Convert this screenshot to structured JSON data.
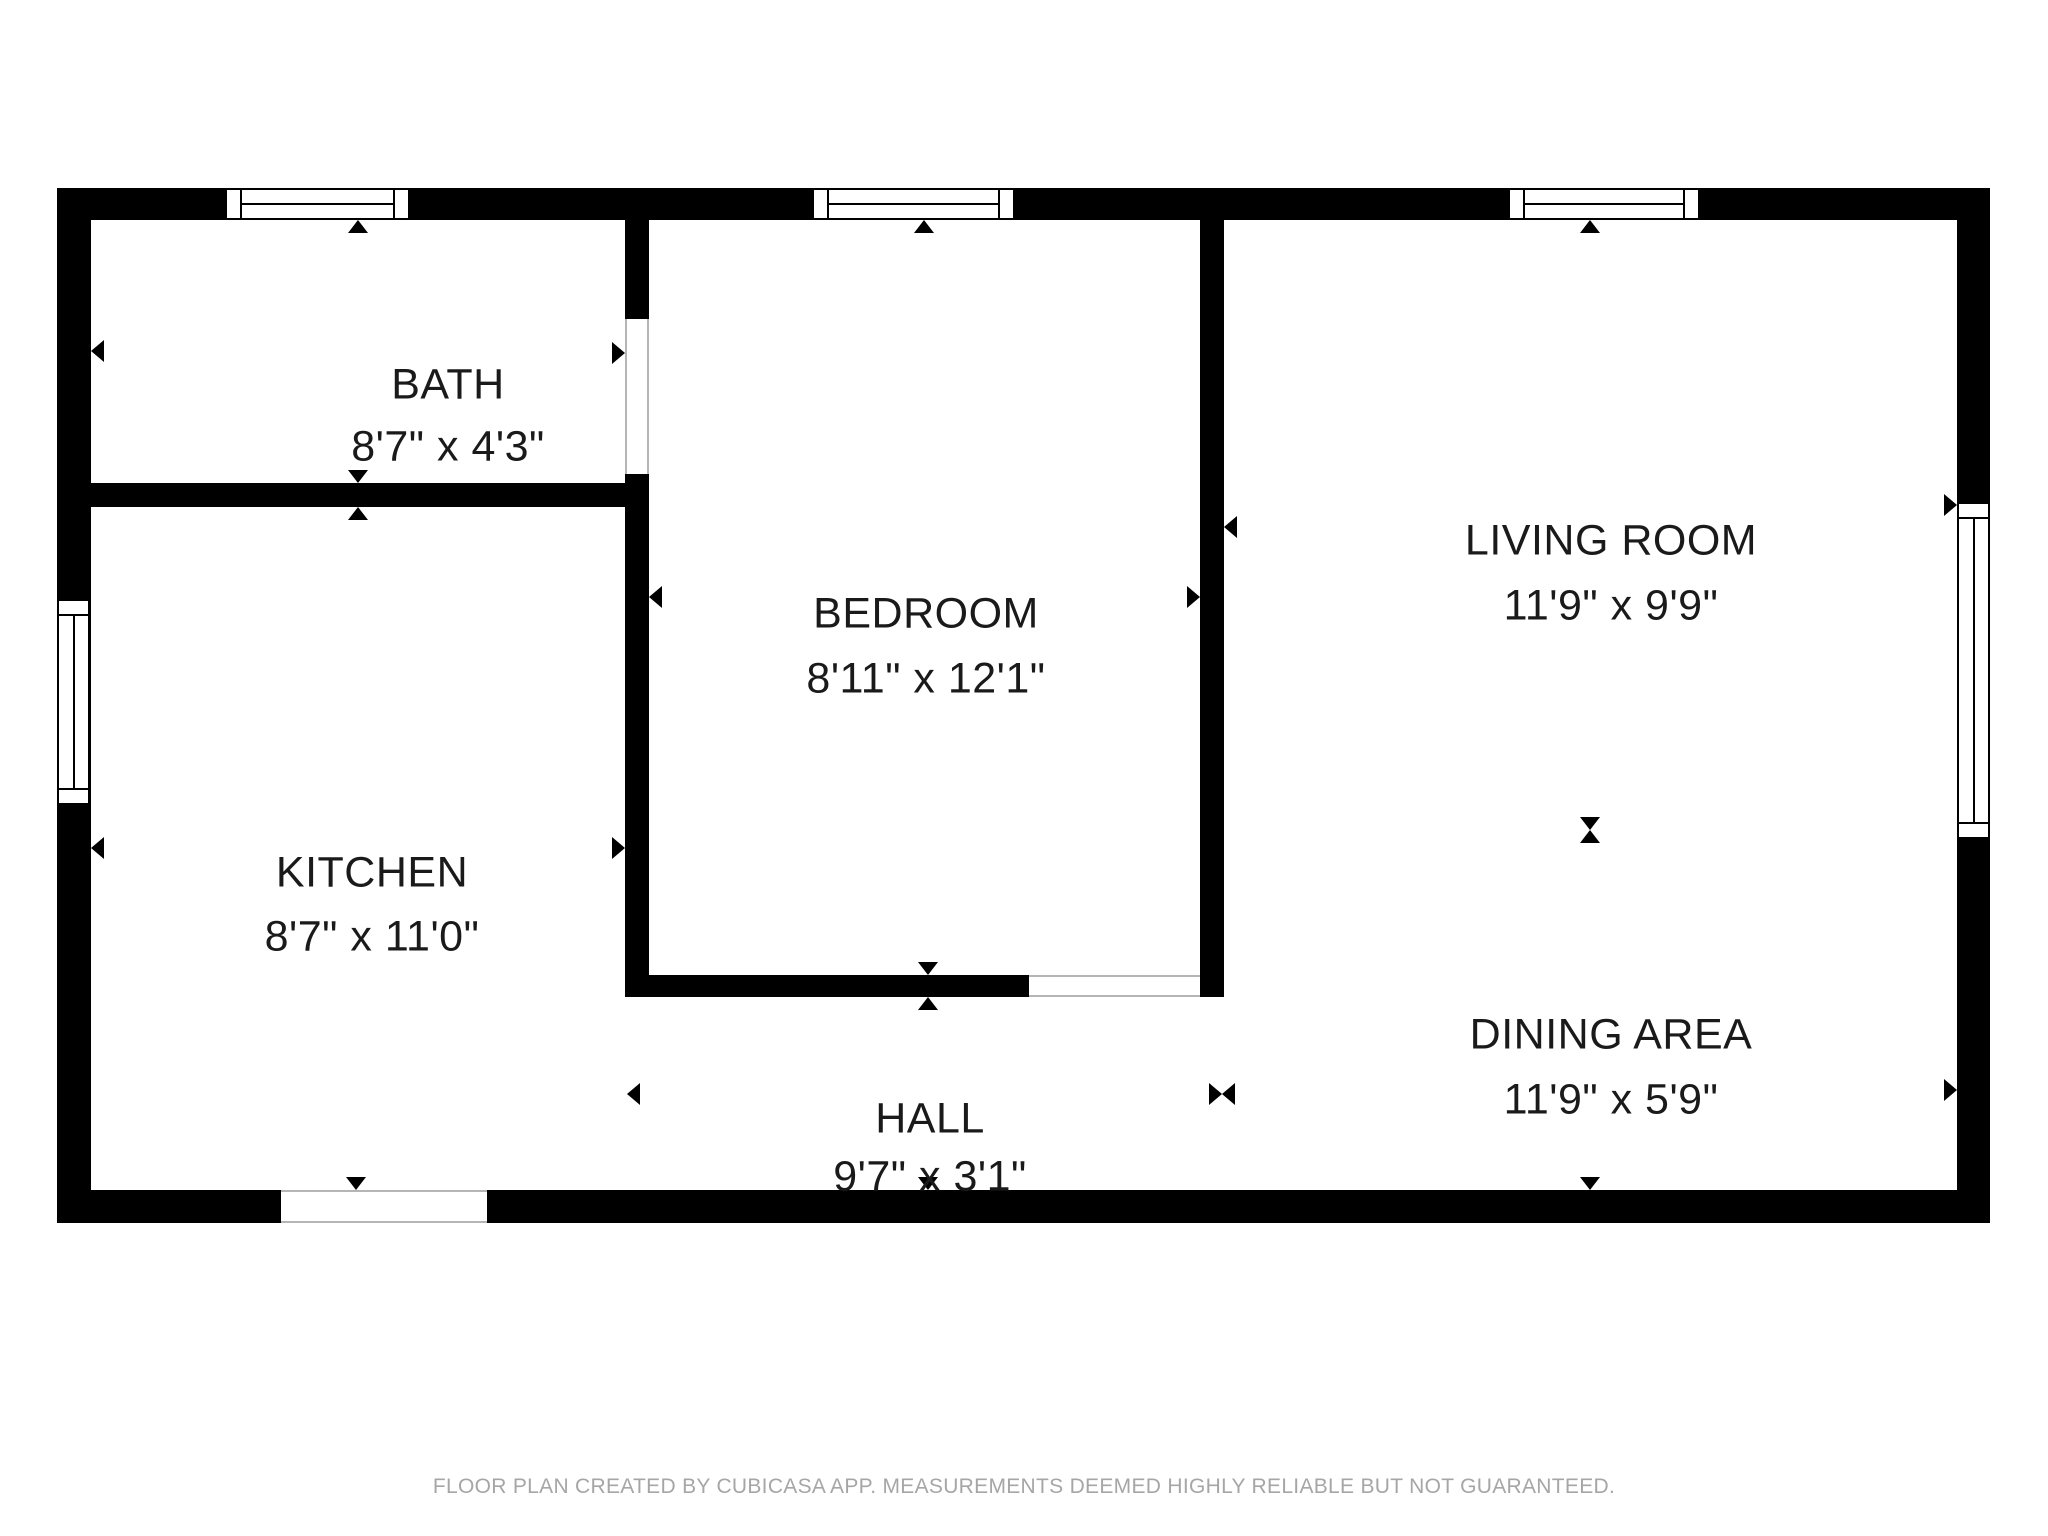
{
  "floor_plan": {
    "rooms": [
      {
        "id": "bath",
        "name": "BATH",
        "dims": "8'7\" x 4'3\""
      },
      {
        "id": "kitchen",
        "name": "KITCHEN",
        "dims": "8'7\" x 11'0\""
      },
      {
        "id": "bedroom",
        "name": "BEDROOM",
        "dims": "8'11\" x 12'1\""
      },
      {
        "id": "living",
        "name": "LIVING ROOM",
        "dims": "11'9\" x 9'9\""
      },
      {
        "id": "dining",
        "name": "DINING AREA",
        "dims": "11'9\" x 5'9\""
      },
      {
        "id": "hall",
        "name": "HALL",
        "dims": "9'7\" x 3'1\""
      }
    ],
    "footer": "FLOOR PLAN CREATED BY CUBICASA APP. MEASUREMENTS DEEMED HIGHLY RELIABLE BUT NOT GUARANTEED.",
    "colors": {
      "wall": "#000000",
      "background": "#ffffff",
      "footer_text": "#a6a6a6"
    }
  }
}
